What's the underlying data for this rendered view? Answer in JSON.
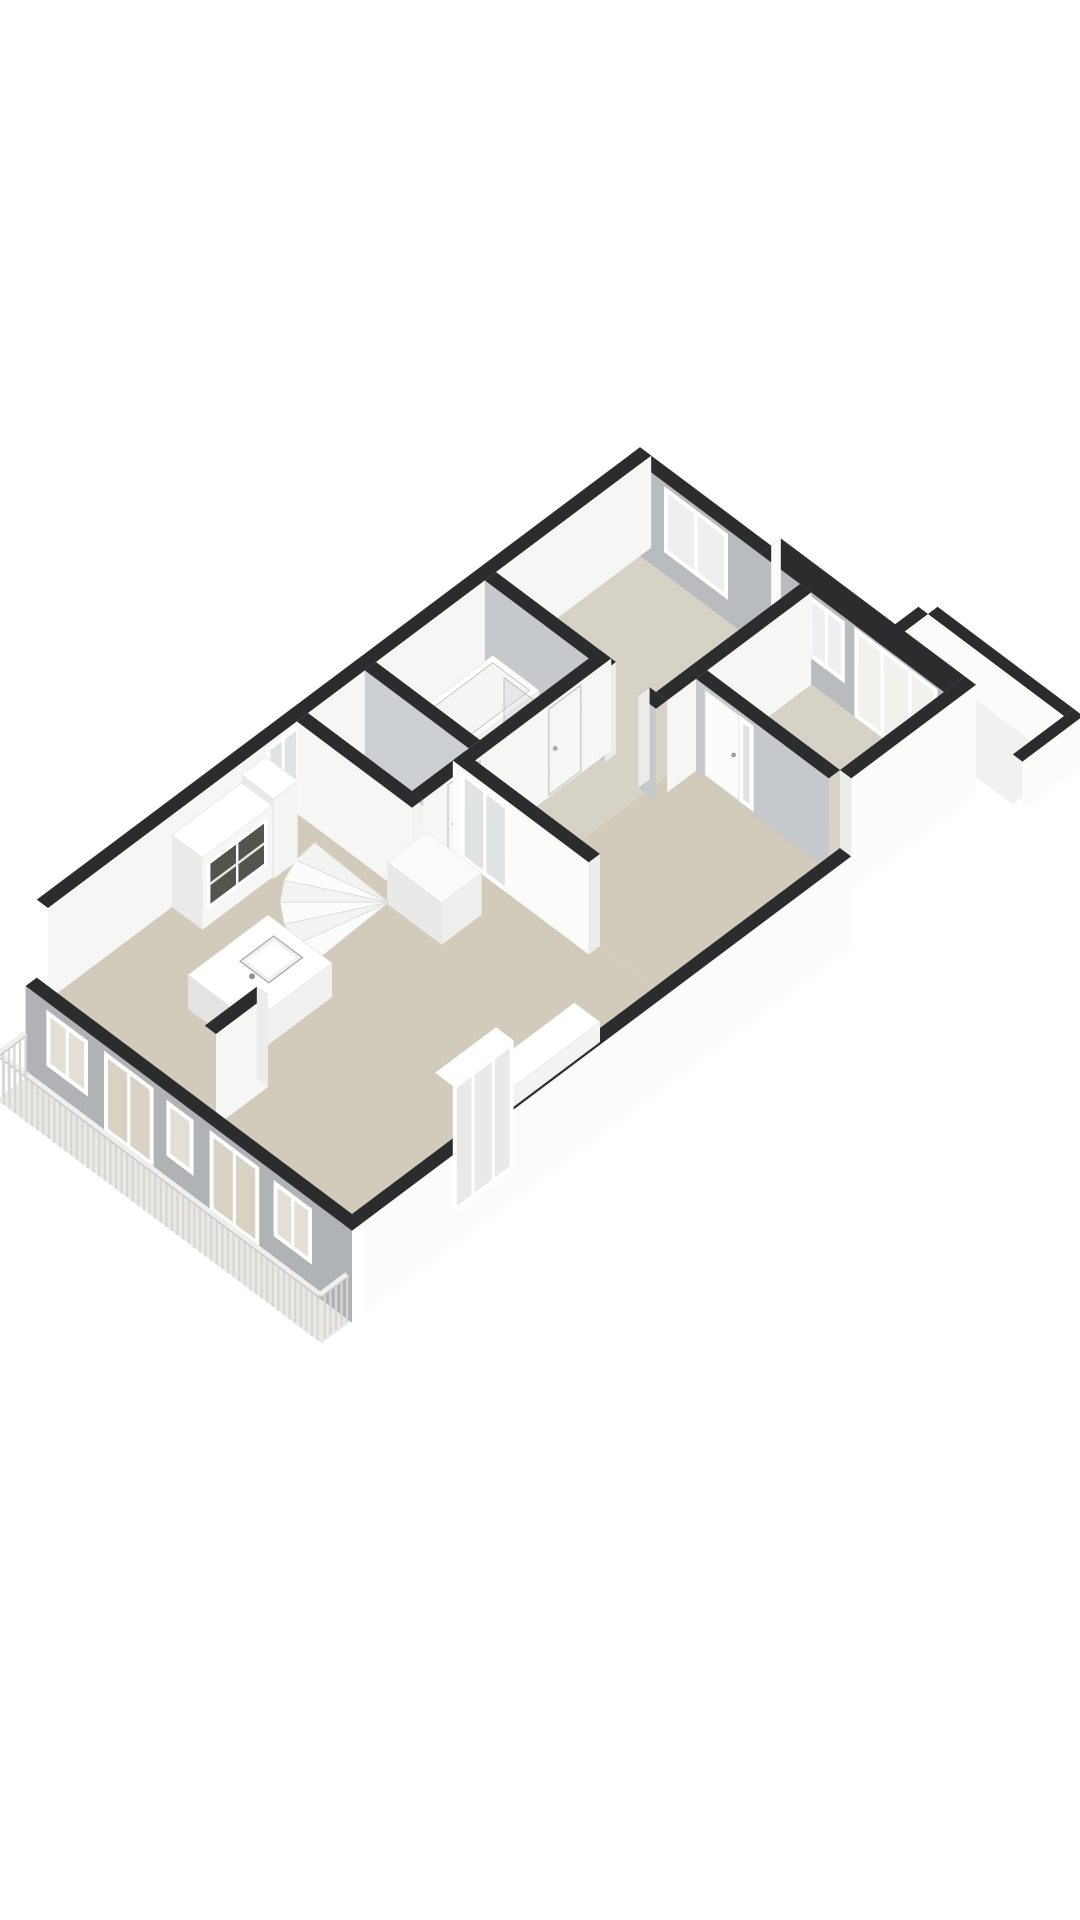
{
  "page": {
    "background": "#ffffff",
    "kind": "3d-floorplan-render"
  },
  "scene": {
    "projection": {
      "cx": 640,
      "cy": 556,
      "kx": 0.8,
      "ky": 0.6,
      "wall_height": 92,
      "thickness": 14
    },
    "palette": {
      "band": "#2b2c2e",
      "exwhite": "#fcfcfb",
      "inwhite": "#f6f6f5",
      "bright": "#fbfbfa",
      "gray": "#b0b3b6",
      "grayin": "#b9bcbf",
      "graylight": "#c6c9cb",
      "graypart": "#cdd0d2",
      "jamb": "#ececea",
      "frame": "#ffffff",
      "floorLiving": "#d2cbbb",
      "floorBed": "#d7d2c6",
      "floorWet": "#f4f3f1",
      "floorBalcony": "#f0f0ee",
      "floorTerrace": "#eae8e3",
      "glassWarm": "#d8d2c4",
      "glassWin": "#e3dfd4",
      "glassCool": "#edeff0",
      "glassPale": "#f2f1ed",
      "glassDoor": "#dfe3e4",
      "dark": "#53544e",
      "baluster": "#d6d6d4",
      "railTop": "#efefed",
      "railLine": "#c9c9c7",
      "stepA": "#fcfcfb",
      "stepB": "#f3f3f1",
      "stepEdge": "#dcdcda"
    },
    "rooms": [
      {
        "name": "living-room",
        "floor": "beige"
      },
      {
        "name": "dining-area",
        "floor": "beige"
      },
      {
        "name": "corridor",
        "floor": "beige-light"
      },
      {
        "name": "bedroom-1",
        "floor": "beige-light"
      },
      {
        "name": "bedroom-2",
        "floor": "beige-light"
      },
      {
        "name": "bathroom",
        "floor": "white"
      },
      {
        "name": "toilet",
        "floor": "white"
      },
      {
        "name": "balcony",
        "floor": "white"
      },
      {
        "name": "terrace",
        "floor": "light"
      }
    ],
    "draw": [
      {
        "t": "floor",
        "name": "living-room-floor",
        "u1": 0,
        "v1": 350,
        "u2": 380,
        "v2": 740,
        "c": "floorLiving"
      },
      {
        "t": "floor",
        "name": "dining-area-floor",
        "u1": 200,
        "v1": 130,
        "u2": 380,
        "v2": 350,
        "c": "floorLiving"
      },
      {
        "t": "floor",
        "name": "corridor-floor",
        "u1": 130,
        "v1": 166,
        "u2": 200,
        "v2": 350,
        "c": "floorBed"
      },
      {
        "t": "floor",
        "name": "bedroom-1-floor",
        "u1": 0,
        "v1": 0,
        "u2": 200,
        "v2": 180,
        "c": "floorBed"
      },
      {
        "t": "floor",
        "name": "bedroom-2-floor",
        "u1": 214,
        "v1": 0,
        "u2": 380,
        "v2": 130,
        "c": "floorBed"
      },
      {
        "t": "floor",
        "name": "bathroom-floor",
        "u1": 0,
        "v1": 180,
        "u2": 130,
        "v2": 330,
        "c": "floorWet"
      },
      {
        "t": "floor",
        "name": "toilet-floor",
        "u1": 0,
        "v1": 330,
        "u2": 130,
        "v2": 415,
        "c": "floorWet"
      },
      {
        "t": "wallV",
        "name": "balcony-parapet-far",
        "v": -90,
        "u1": 270,
        "u2": 440,
        "th": 12,
        "out": -1,
        "h": 50,
        "face": "in",
        "fc": "exwhite"
      },
      {
        "t": "wallU",
        "name": "balcony-parapet-left",
        "u": 270,
        "v1": -90,
        "v2": -26,
        "th": 12,
        "out": -1,
        "h": 50,
        "face": "in",
        "fc": "exwhite"
      },
      {
        "t": "floor",
        "name": "balcony-floor",
        "u1": 270,
        "v1": -90,
        "u2": 440,
        "v2": -26,
        "c": "floorBalcony"
      },
      {
        "t": "wallU",
        "name": "balcony-parapet-right",
        "u": 440,
        "v1": -102,
        "v2": -26,
        "th": 12,
        "out": 1,
        "h": 50,
        "face": "out",
        "fc": "exwhite"
      },
      {
        "t": "wallV",
        "name": "exterior-wall-north-a",
        "v": 0,
        "u1": -14,
        "u2": 150,
        "th": 14,
        "out": -1,
        "h": 92,
        "face": "in",
        "fc": "grayin"
      },
      {
        "t": "wallV",
        "name": "exterior-wall-north-b",
        "v": 0,
        "u1": 150,
        "u2": 380,
        "th": 26,
        "out": -1,
        "h": 92,
        "face": "in",
        "fc": "grayin"
      },
      {
        "t": "quad",
        "name": "notch-cap",
        "pts": [
          [
            150,
            -26,
            92
          ],
          [
            150,
            -14,
            92
          ],
          [
            150,
            -14,
            0
          ],
          [
            150,
            -26,
            0
          ]
        ],
        "c": "exwhite"
      },
      {
        "t": "win",
        "name": "bedroom-1-window",
        "plane": "v",
        "at": 0,
        "a1": 30,
        "a2": 110,
        "z1": 22,
        "z2": 88,
        "glass": "glassCool",
        "mull": 1
      },
      {
        "t": "win",
        "name": "bedroom-2-window",
        "plane": "v",
        "at": 0,
        "a1": 210,
        "a2": 256,
        "z1": 26,
        "z2": 88,
        "glass": "glassCool",
        "mull": 1
      },
      {
        "t": "win",
        "name": "bedroom-2-balcony-doors",
        "plane": "v",
        "at": 0,
        "a1": 268,
        "a2": 372,
        "z1": 0,
        "z2": 90,
        "glass": "glassPale",
        "mull": 2
      },
      {
        "t": "wallU",
        "name": "exterior-wall-west",
        "u": 0,
        "v1": -14,
        "v2": 740,
        "th": 14,
        "out": -1,
        "h": 92,
        "face": "in",
        "fc": "inwhite"
      },
      {
        "t": "win",
        "name": "stairwell-glass-door",
        "plane": "u",
        "at": 0,
        "a1": 425,
        "a2": 467,
        "z1": 0,
        "z2": 88,
        "glass": "glassDoor",
        "mull": 1
      },
      {
        "t": "wallU",
        "name": "partition-bedroom1-east",
        "u": 200,
        "v1": 0,
        "v2": 180,
        "th": 14,
        "out": 1,
        "h": 92,
        "face": "out",
        "fc": "inwhite"
      },
      {
        "t": "wallV",
        "name": "partition-bedroom1-south",
        "v": 180,
        "u1": 0,
        "u2": 214,
        "th": 14,
        "out": 1,
        "h": 92,
        "face": "out",
        "fc": "graylight",
        "gaps": [
          {
            "a1": 150,
            "a2": 192
          }
        ]
      },
      {
        "t": "wallV",
        "name": "partition-bedroom2-south",
        "v": 130,
        "u1": 214,
        "u2": 380,
        "th": 14,
        "out": 1,
        "h": 92,
        "face": "out",
        "fc": "graylight"
      },
      {
        "t": "win",
        "name": "bedroom-2-door",
        "plane": "v",
        "at": 144,
        "a1": 225,
        "a2": 268,
        "z1": 2,
        "z2": 88,
        "style": "leaf"
      },
      {
        "t": "win",
        "name": "bedroom-2-door-sidelight",
        "plane": "v",
        "at": 144,
        "a1": 268,
        "a2": 286,
        "z1": 2,
        "z2": 88,
        "glass": "glassDoor",
        "mull": 0
      },
      {
        "t": "box",
        "name": "bathtub",
        "u1": 6,
        "v1": 190,
        "u2": 64,
        "v2": 320,
        "h": 18,
        "cT": "frame",
        "cU": "#f0f0ee",
        "cV": "#e9e9e7"
      },
      {
        "t": "quad",
        "name": "bathtub-rim",
        "pts": [
          [
            12,
            196,
            18
          ],
          [
            58,
            196,
            18
          ],
          [
            58,
            314,
            18
          ],
          [
            12,
            314,
            18
          ]
        ],
        "c": "#f5f5f3",
        "stroke": "#c8c8c6"
      },
      {
        "t": "pane",
        "name": "shower-screen-a",
        "plane": "v",
        "at": 238,
        "a1": 68,
        "a2": 122,
        "z1": 0,
        "z2": 62
      },
      {
        "t": "pane",
        "name": "shower-screen-b",
        "plane": "u",
        "at": 122,
        "a1": 184,
        "a2": 238,
        "z1": 0,
        "z2": 62
      },
      {
        "t": "box",
        "name": "toilet-fixture",
        "u1": 14,
        "v1": 342,
        "u2": 50,
        "v2": 384,
        "h": 24,
        "cT": "frame",
        "cU": "#f1f1ef",
        "cV": "#eaeae8"
      },
      {
        "t": "quad",
        "name": "toilet-lid",
        "pts": [
          [
            19,
            348,
            24
          ],
          [
            45,
            348,
            24
          ],
          [
            45,
            378,
            24
          ],
          [
            19,
            378,
            24
          ]
        ],
        "c": "#f3f3f1",
        "stroke": "#cfcfcd"
      },
      {
        "t": "wallV",
        "name": "partition-bath-toilet",
        "v": 330,
        "u1": 0,
        "u2": 130,
        "th": 14,
        "out": 1,
        "h": 92,
        "face": "out",
        "fc": "graypart"
      },
      {
        "t": "wallU",
        "name": "partition-bath-east",
        "u": 130,
        "v1": 180,
        "v2": 415,
        "th": 14,
        "out": 1,
        "h": 92,
        "face": "out",
        "fc": "inwhite"
      },
      {
        "t": "win",
        "name": "bathroom-door",
        "plane": "u",
        "at": 144,
        "a1": 218,
        "a2": 258,
        "z1": 2,
        "z2": 88,
        "style": "outline"
      },
      {
        "t": "win",
        "name": "toilet-door",
        "plane": "u",
        "at": 144,
        "a1": 344,
        "a2": 384,
        "z1": 2,
        "z2": 88,
        "style": "outline"
      },
      {
        "t": "wallV",
        "name": "partition-toilet-south",
        "v": 415,
        "u1": 0,
        "u2": 144,
        "th": 14,
        "out": 1,
        "h": 92,
        "face": "out",
        "fc": "inwhite"
      },
      {
        "t": "wallV",
        "name": "partition-hall-living",
        "v": 350,
        "u1": 130,
        "u2": 300,
        "th": 14,
        "out": 1,
        "h": 92,
        "face": "out",
        "fc": "bright",
        "cap": "end"
      },
      {
        "t": "win",
        "name": "hall-glass-door",
        "plane": "v",
        "at": 364,
        "a1": 140,
        "a2": 200,
        "z1": 0,
        "z2": 88,
        "glass": "glassDoor",
        "mull": 1
      },
      {
        "t": "box",
        "name": "stair-landing",
        "u1": 132,
        "v1": 398,
        "u2": 200,
        "v2": 448,
        "h": 42,
        "cT": "#fbfbfa",
        "cU": "#efefed",
        "cV": "#e9e9e7"
      },
      {
        "t": "fan",
        "name": "spiral-staircase",
        "cu": 134,
        "cv": 448,
        "r": 96,
        "a1": 88,
        "a2": 182,
        "steps": 6
      },
      {
        "t": "box",
        "name": "hall-cabinet",
        "u1": 0,
        "v1": 468,
        "u2": 40,
        "v2": 498,
        "h": 80,
        "cT": "frame",
        "cU": "#f4f4f2",
        "cV": "#e9e9e7"
      },
      {
        "t": "box",
        "name": "display-cabinet",
        "u1": 0,
        "v1": 498,
        "u2": 38,
        "v2": 585,
        "h": 72,
        "cT": "frame",
        "cU": "#f6f6f4",
        "cV": "#eaeae8"
      },
      {
        "t": "panes",
        "name": "display-cabinet-glass",
        "plane": "u",
        "at": 38,
        "a1": 504,
        "a2": 579,
        "z1": 16,
        "z2": 64
      },
      {
        "t": "box",
        "name": "kitchen-island",
        "u1": 95,
        "v1": 560,
        "u2": 175,
        "v2": 660,
        "h": 34,
        "cT": "frame",
        "cU": "#f1f1ef",
        "cV": "#e3e3e1"
      },
      {
        "t": "sink",
        "name": "kitchen-sink",
        "u1": 116,
        "v1": 574,
        "u2": 152,
        "v2": 616,
        "z": 34
      },
      {
        "t": "wallU",
        "name": "exterior-wall-east-high",
        "u": 380,
        "v1": -26,
        "v2": 130,
        "th": 14,
        "out": 1,
        "h": 92,
        "fz2": -20,
        "face": "out",
        "fc": "exwhite"
      },
      {
        "t": "wallU",
        "name": "exterior-wall-east-low",
        "u": 380,
        "v1": 130,
        "v2": 740,
        "th": 14,
        "out": 1,
        "h": 14,
        "fz2": -78,
        "face": "out",
        "fc": "exwhite"
      },
      {
        "t": "quad",
        "name": "east-step-cap",
        "pts": [
          [
            380,
            130,
            92
          ],
          [
            394,
            130,
            92
          ],
          [
            394,
            130,
            14
          ],
          [
            380,
            130,
            14
          ]
        ],
        "c": "jamb"
      },
      {
        "t": "box",
        "name": "sideboard",
        "u1": 348,
        "v1": 430,
        "u2": 380,
        "v2": 560,
        "h": 20,
        "cT": "frame",
        "cU": "#f3f3f1",
        "cV": "#e7e7e5"
      },
      {
        "t": "quad",
        "name": "glazed-unit-top",
        "pts": [
          [
            376,
            556,
            88
          ],
          [
            398,
            556,
            88
          ],
          [
            398,
            632,
            88
          ],
          [
            376,
            632,
            88
          ]
        ],
        "c": "frame"
      },
      {
        "t": "win",
        "name": "glazed-door-unit",
        "plane": "u",
        "at": 398,
        "a1": 556,
        "a2": 632,
        "z1": -40,
        "z2": 88,
        "glass": "#e9e9e7",
        "mull": 2
      },
      {
        "t": "wallU",
        "name": "kitchen-stub-wall",
        "u": 196,
        "v1": 675,
        "v2": 740,
        "th": 14,
        "out": 1,
        "h": 92,
        "face": "out",
        "fc": "inwhite",
        "cap": "start"
      },
      {
        "t": "wallV",
        "name": "exterior-wall-south",
        "v": 740,
        "u1": -14,
        "u2": 394,
        "th": 14,
        "out": 1,
        "h": 14,
        "fz2": -78,
        "face": "out",
        "fc": "gray"
      },
      {
        "t": "win",
        "name": "living-window-1",
        "plane": "v",
        "at": 754,
        "a1": 12,
        "a2": 64,
        "z1": -50,
        "z2": 6,
        "glass": "glassWin",
        "mull": 1
      },
      {
        "t": "win",
        "name": "terrace-door-1",
        "plane": "v",
        "at": 754,
        "a1": 84,
        "a2": 146,
        "z1": -72,
        "z2": 8,
        "glass": "glassWarm",
        "mull": 1
      },
      {
        "t": "win",
        "name": "living-window-2",
        "plane": "v",
        "at": 754,
        "a1": 162,
        "a2": 196,
        "z1": -50,
        "z2": 6,
        "glass": "glassWin",
        "mull": 0
      },
      {
        "t": "win",
        "name": "terrace-door-2",
        "plane": "v",
        "at": 754,
        "a1": 216,
        "a2": 278,
        "z1": -72,
        "z2": 8,
        "glass": "glassWarm",
        "mull": 1
      },
      {
        "t": "win",
        "name": "living-window-3",
        "plane": "v",
        "at": 754,
        "a1": 296,
        "a2": 344,
        "z1": -50,
        "z2": 6,
        "glass": "glassWin",
        "mull": 1
      },
      {
        "t": "quad",
        "name": "terrace-floor",
        "pts": [
          [
            -14,
            754,
            -78
          ],
          [
            392,
            754,
            -78
          ],
          [
            392,
            790,
            -78
          ],
          [
            -14,
            790,
            -78
          ]
        ],
        "c": "floorTerrace"
      },
      {
        "t": "rail",
        "name": "terrace-railing-front",
        "axis": "u",
        "at": 790,
        "from": -12,
        "to": 390,
        "step": 7,
        "zb": -78,
        "h": 44
      },
      {
        "t": "rail",
        "name": "terrace-railing-left",
        "axis": "v",
        "at": -12,
        "from": 756,
        "to": 790,
        "step": 7,
        "zb": -78,
        "h": 44
      },
      {
        "t": "rail",
        "name": "terrace-railing-right",
        "axis": "v",
        "at": 390,
        "from": 756,
        "to": 790,
        "step": 7,
        "zb": -78,
        "h": 44
      }
    ]
  }
}
